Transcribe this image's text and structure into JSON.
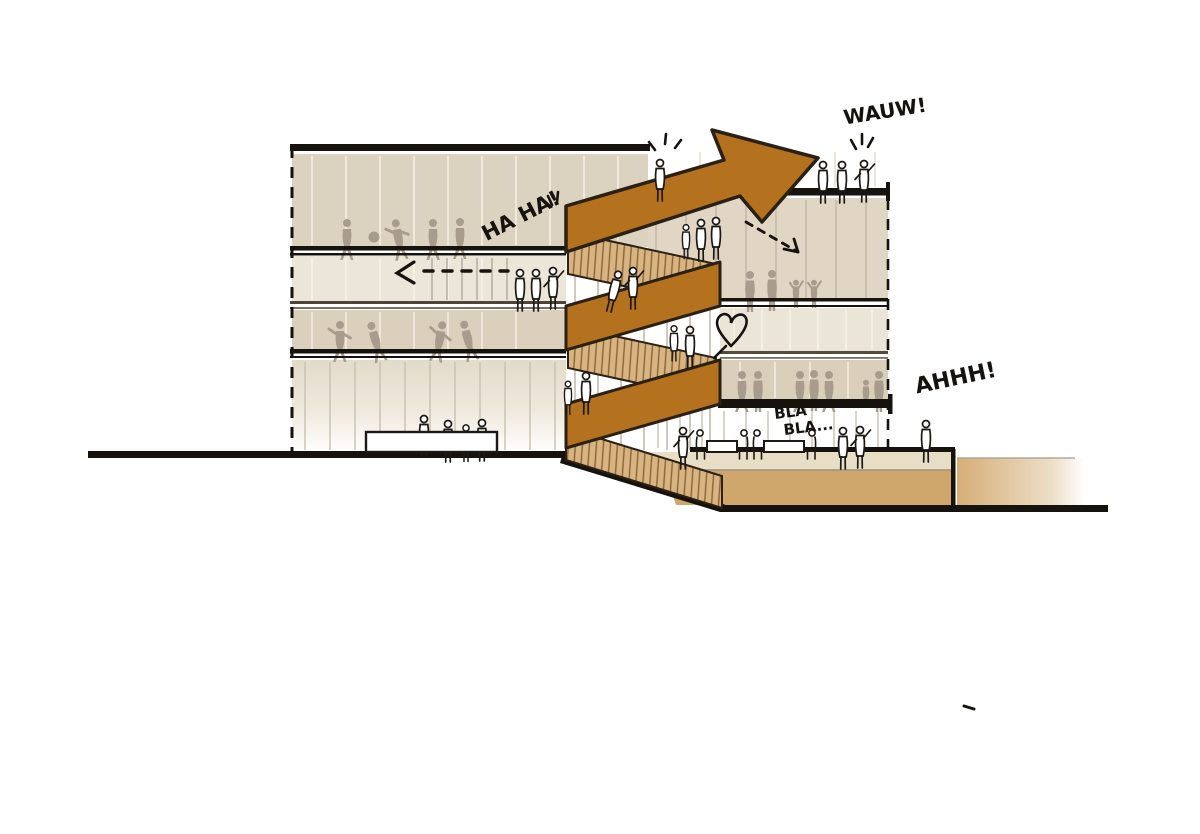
{
  "artwork": {
    "type": "architectural-section-sketch",
    "annotations": {
      "wauw": "WAUW!",
      "haha": "HA HA!",
      "ahhh": "AHHH!",
      "bla1": "BLA",
      "bla2": "BLA..."
    },
    "colors": {
      "ribbon_solid": "#b4721e",
      "ribbon_outline": "#2a2013",
      "stair_treads": "#d7b481",
      "tread_line": "#8a6434",
      "band_beige": "#dcd2c0",
      "band_cream": "#ece6d8",
      "band_tan": "#dbd0bc",
      "plaza_front": "#cfa76c",
      "plaza_top": "#e8dec6",
      "silhouette_gray": "#a89d8d",
      "ink": "#16120e"
    }
  }
}
